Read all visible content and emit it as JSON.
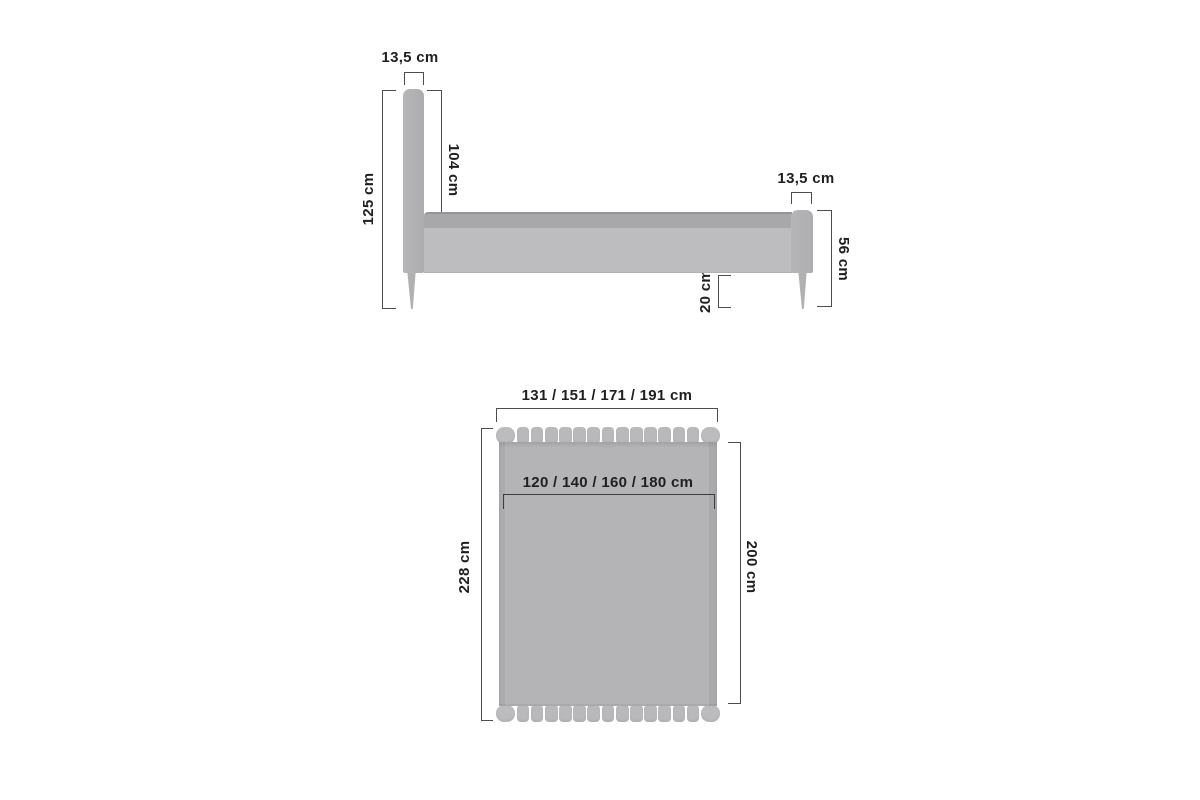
{
  "title": "Bed dimension diagram",
  "colors": {
    "background": "#ffffff",
    "upholstery": "#b4b4b6",
    "upholstery_dark": "#a8a8aa",
    "rail": "#bdbdbf",
    "slat": "#b9b9bb",
    "dimension_line": "#4d4d4d",
    "text": "#1f1f1f"
  },
  "side_view": {
    "headboard_width_label": "13,5 cm",
    "headboard_height_label": "125 cm",
    "headboard_to_rail_label": "104 cm",
    "rail_height_label": "26 cm",
    "footboard_width_label": "13,5 cm",
    "footboard_height_label": "56 cm",
    "floor_clearance_label": "20 cm"
  },
  "top_view": {
    "outer_width_label": "131 / 151 / 171 / 191 cm",
    "mattress_width_label": "120 / 140 / 160 / 180  cm",
    "outer_length_label": "228 cm",
    "mattress_length_label": "200 cm"
  }
}
